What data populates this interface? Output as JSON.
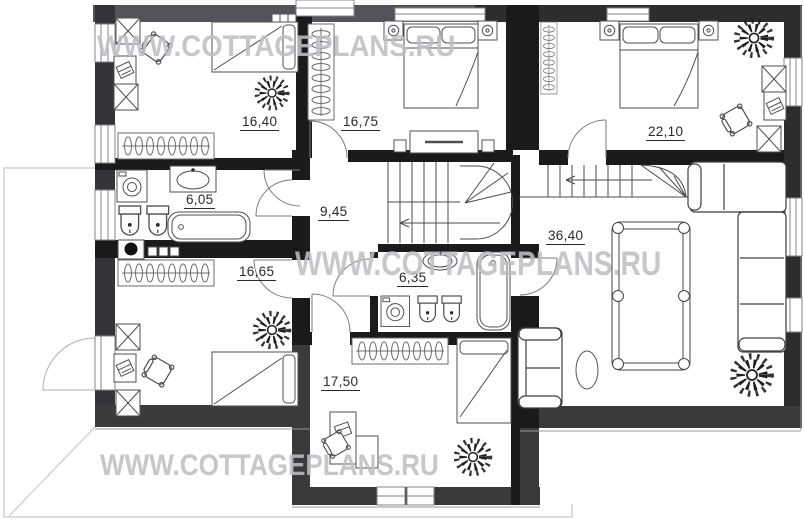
{
  "watermark": {
    "text": "WWW.COTTAGEPLANS.RU"
  },
  "plan_title": "Second floor plan",
  "rooms": [
    {
      "key": "bedroom-top-left",
      "area": "16,40",
      "furniture": [
        "wardrobe",
        "desk",
        "chair",
        "tall-wardrobe",
        "single-bed",
        "plant",
        "radiator"
      ]
    },
    {
      "key": "bedroom-top-middle",
      "area": "16,75",
      "furniture": [
        "radiator",
        "nightstand",
        "double-bed",
        "nightstand",
        "dresser"
      ]
    },
    {
      "key": "bedroom-top-right",
      "area": "22,10",
      "furniture": [
        "radiator",
        "nightstand",
        "double-bed",
        "nightstand",
        "plant",
        "wardrobe",
        "desk",
        "chair",
        "wardrobe"
      ]
    },
    {
      "key": "bathroom-left",
      "area": "6,05",
      "furniture": [
        "washing-machine",
        "sink",
        "toilet",
        "bidet",
        "bathtub",
        "boiler"
      ]
    },
    {
      "key": "hallway",
      "area": "9,45",
      "furniture": [
        "staircase"
      ]
    },
    {
      "key": "bedroom-bottom-left",
      "area": "16,65",
      "furniture": [
        "radiator",
        "wardrobe",
        "desk",
        "chair",
        "wardrobe",
        "single-bed",
        "plant"
      ]
    },
    {
      "key": "bathroom-middle",
      "area": "6,35",
      "furniture": [
        "sink",
        "washing-machine",
        "toilet",
        "bidet",
        "bathtub"
      ]
    },
    {
      "key": "living-room",
      "area": "36,40",
      "furniture": [
        "staircase",
        "corner-sofa",
        "loveseat",
        "billiard-table",
        "side-table",
        "plant"
      ]
    },
    {
      "key": "bedroom-bottom-mid",
      "area": "17,50",
      "furniture": [
        "radiator",
        "single-bed",
        "desk",
        "chair",
        "plant"
      ]
    }
  ],
  "colors": {
    "wall_dark": "#2d2d30",
    "wall_gray": "#4f5055",
    "interior_wall": "#1a1a1c",
    "furniture_line": "#55565a",
    "label_text": "#2a2a2c",
    "watermark": "#c4c4c8"
  }
}
